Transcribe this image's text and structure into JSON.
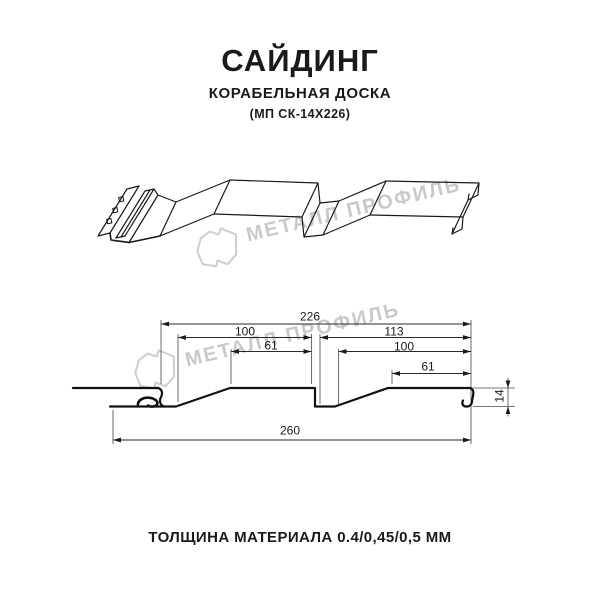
{
  "header": {
    "title": "САЙДИНГ",
    "subtitle": "КОРАБЕЛЬНАЯ ДОСКА",
    "product_code": "(МП СК-14Х226)"
  },
  "watermark": {
    "brand_text": "МЕТАЛЛ ПРОФИЛЬ",
    "logo_icon": "metal-profil-logo",
    "color": "#c9c9c9"
  },
  "section_drawing": {
    "dims": {
      "cover_width": "226",
      "left_panel": "100",
      "left_panel_top": "61",
      "right_group": "113",
      "right_panel": "100",
      "right_panel_top": "61",
      "overall_width": "260",
      "profile_height": "14"
    }
  },
  "footer": {
    "thickness_note": "ТОЛЩИНА МАТЕРИАЛА 0.4/0,45/0,5 ММ"
  },
  "colors": {
    "line": "#1a1a1a",
    "watermark": "#c9c9c9",
    "background": "#ffffff"
  }
}
